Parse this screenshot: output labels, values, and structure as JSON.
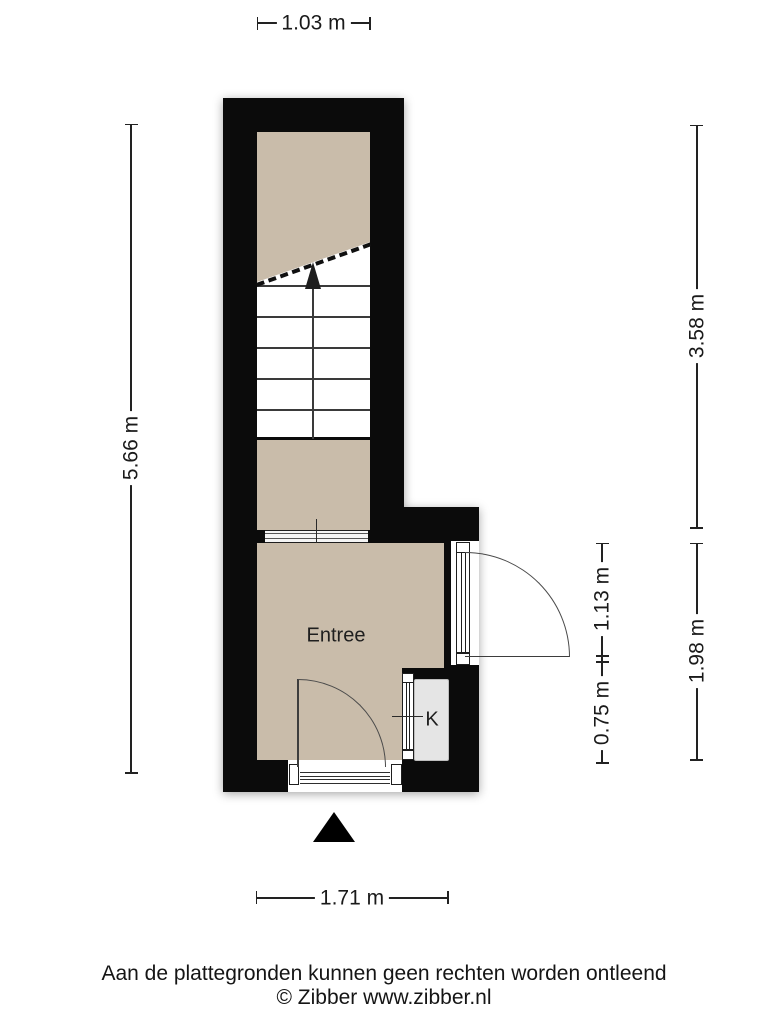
{
  "floorplan": {
    "rooms": {
      "entree": "Entree",
      "closet": "K"
    },
    "dimensions": {
      "top": "1.03 m",
      "left": "5.66 m",
      "right_upper": "3.58 m",
      "right_lower": "1.98 m",
      "inner_door": "1.13 m",
      "inner_closet": "0.75 m",
      "bottom": "1.71 m"
    },
    "icons": {
      "entrance_arrow": "solid-triangle-up",
      "stairs_direction_arrow": "solid-triangle-up"
    },
    "colors": {
      "wall": "#0b0b0b",
      "floor": "#c9bcaa",
      "closet_floor": "#e5e5e5",
      "stairs": "#ffffff",
      "background": "#ffffff"
    }
  },
  "footer": {
    "disclaimer": "Aan de plattegronden kunnen geen rechten worden ontleend",
    "copyright": "© Zibber www.zibber.nl"
  }
}
